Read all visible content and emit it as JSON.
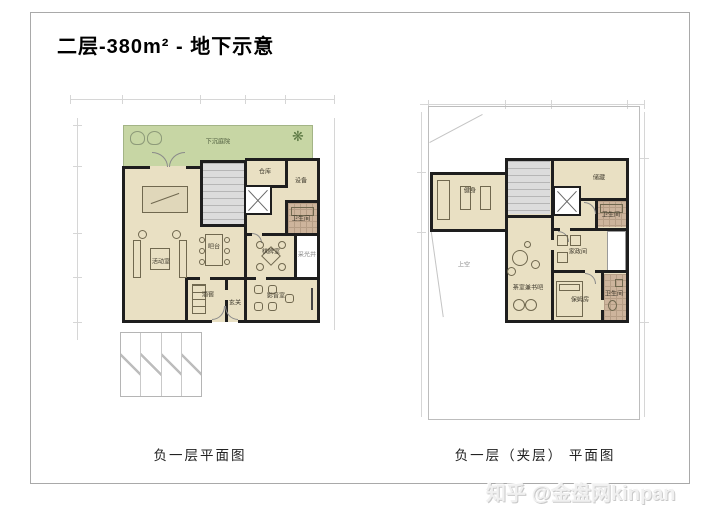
{
  "title": "二层-380m² - 地下示意",
  "watermark": "知乎 @金盘网kinpan",
  "icons": {
    "tree": "❋"
  },
  "colors": {
    "floor": "#e9e0c3",
    "courtyard_green": "#c7d6a4",
    "bath_tile": "#cdb49c",
    "stairs_gray": "#dcdcdc",
    "wall_black": "#1e1e1e",
    "frame_gray": "#a9a9a9"
  },
  "left_plan": {
    "caption": "负一层平面图",
    "rooms": {
      "courtyard": "下沉庭院",
      "storeroom": "仓库",
      "equipment": "设备",
      "bathroom": "卫生间",
      "activity": "活动室",
      "bar": "吧台",
      "chess": "棋牌室",
      "lightwell": "采光井",
      "wine_cellar": "酒窖",
      "foyer": "玄关",
      "av_room": "影音室"
    }
  },
  "right_plan": {
    "caption": "负一层（夹层） 平面图",
    "rooms": {
      "gym": "健身",
      "storage": "储藏",
      "bathroom_top": "卫生间",
      "housekeeping": "家政间",
      "tea_book_bar": "茶室兼书吧",
      "nanny": "保姆房",
      "bathroom_bottom": "卫生间",
      "void": "上空"
    }
  }
}
